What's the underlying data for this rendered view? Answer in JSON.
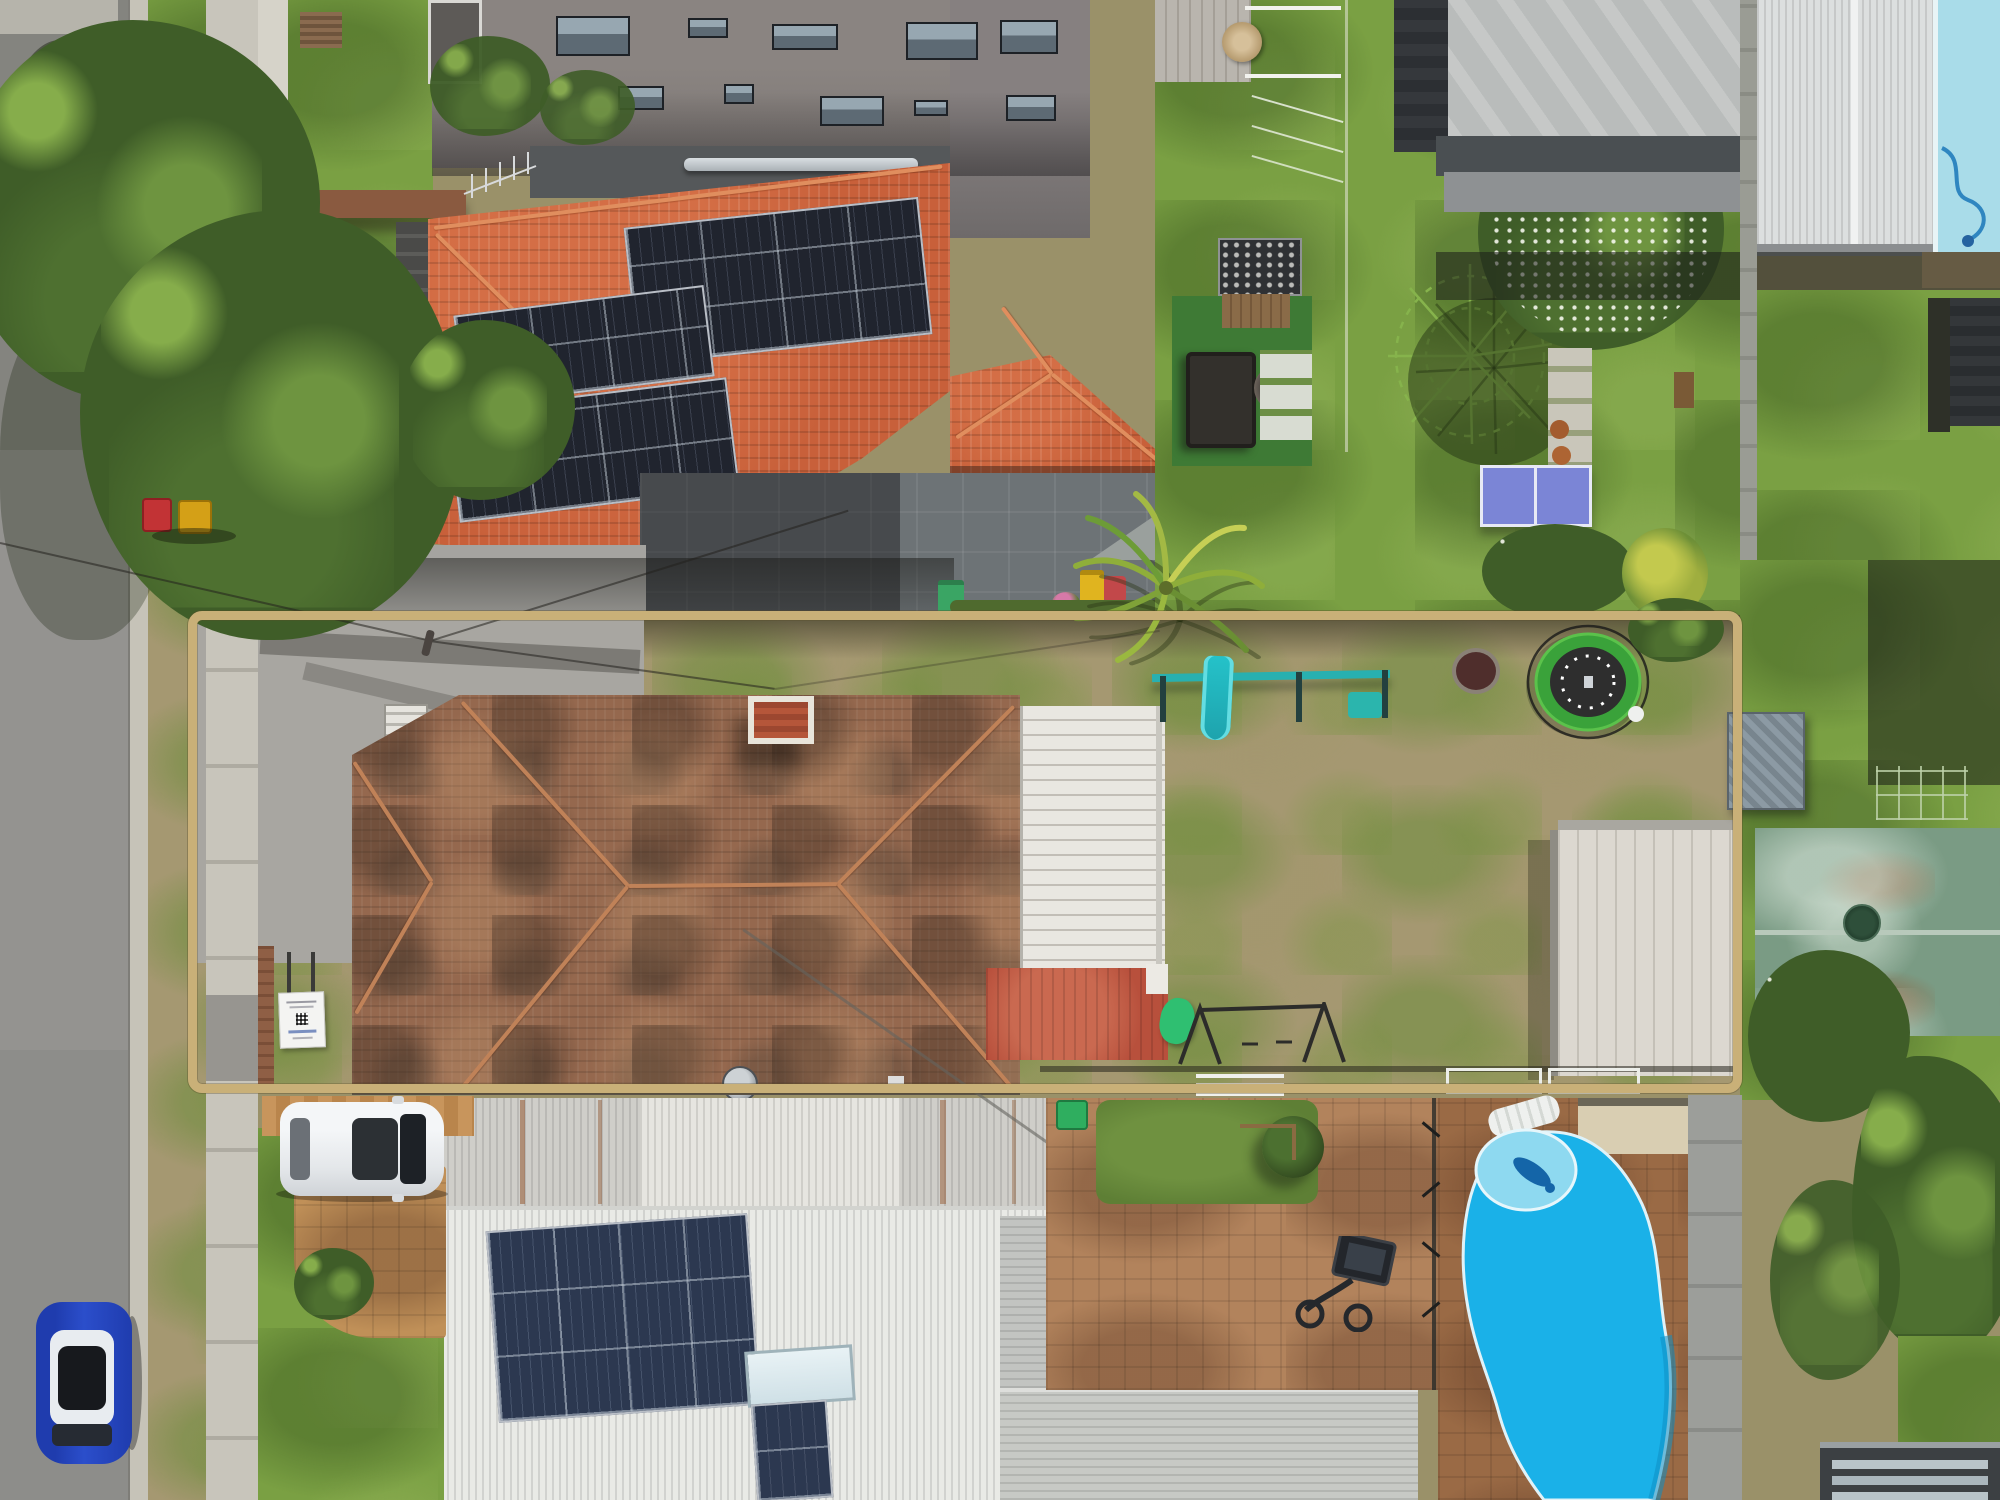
{
  "meta": {
    "domain": "Natural-Image",
    "image_type": "aerial drone photograph, top-down (nadir) view",
    "subject": "suburban residential block with a single property lot highlighted by a tan boundary outline overlay",
    "visible_text": "none legible (small white for-sale signboard with QR code is unreadable)"
  },
  "overlay": {
    "boundary_color": "#c9b078",
    "boundary_shape": "rounded rectangle outline around the middle property lot"
  },
  "palette": {
    "road_asphalt": "#8e8e8c",
    "concrete_path": "#c8c5bb",
    "bright_terracotta_roof": "#c8603a",
    "weathered_tile_roof": "#95684e",
    "solar_panel": "#20242e",
    "healthy_lawn": "#7aa043",
    "dry_patchy_lawn": "#a59871",
    "pool_water": "#1ab1e8",
    "pale_pool_water": "#a9dce9",
    "white_metal_roof": "#e9eae6",
    "green_metal_roof": "#7a9b84",
    "brick_paving": "#b2835c",
    "trampoline_pad": "#3aa23a",
    "play_gym_teal": "#28b0b0"
  },
  "scene": {
    "objects": [
      {
        "name": "road",
        "label": "asphalt street along left edge with concrete kerb, verge and footpath"
      },
      {
        "name": "street-trees",
        "label": "large green street trees casting shadows over road (top left)"
      },
      {
        "name": "apartment-building",
        "label": "grey multi-storey apartment building wall with windows (top centre)"
      },
      {
        "name": "orange-roof-house",
        "label": "two-storey house with bright terracotta tile hip roof and three black solar arrays"
      },
      {
        "name": "garage-orange-roof",
        "label": "detached garage with terracotta roof and four solar panels"
      },
      {
        "name": "courtyard",
        "label": "dark grey paved courtyard with green and yellow wheelie bins"
      },
      {
        "name": "ping-pong-table",
        "label": "blue table-tennis table on lawn"
      },
      {
        "name": "flowering-tree",
        "label": "large white-flowering tree on neighbouring lawn"
      },
      {
        "name": "rotary-clothesline",
        "label": "rotary hoist clothesline on lawn"
      },
      {
        "name": "highlighted-lot",
        "label": "subject property: weathered terracotta-roof house, white carport roof, patchy backyard"
      },
      {
        "name": "for-sale-sign",
        "label": "small white signboard with QR code in front yard"
      },
      {
        "name": "trampoline",
        "label": "round trampoline with green padding and enclosure net"
      },
      {
        "name": "play-gym",
        "label": "teal children's play gym with slide"
      },
      {
        "name": "swing-frame",
        "label": "black A-frame swing set"
      },
      {
        "name": "backyard-shed",
        "label": "large shed with white speckled roof (rear of lot)"
      },
      {
        "name": "palm-tree",
        "label": "palm tree overhanging the top boundary line"
      },
      {
        "name": "white-roof-house",
        "label": "neighbour below: white corrugated hip roof with solar array and skylight"
      },
      {
        "name": "swimming-pool",
        "label": "bright blue kidney-shaped in-ground pool with spa section and brick surround"
      },
      {
        "name": "pool-top-right",
        "label": "second pale-blue pool at top right corner"
      },
      {
        "name": "green-roof-house",
        "label": "weathered green corrugated roof house (right edge)"
      },
      {
        "name": "white-car",
        "label": "white SUV parked on brick driveway (bottom left)"
      },
      {
        "name": "blue-car",
        "label": "blue car with white roof parked on street (bottom left)"
      },
      {
        "name": "wheelie-bins",
        "label": "red and yellow bins on verge; green bins near fences"
      },
      {
        "name": "basketball-hoop",
        "label": "toppled basketball hoop unit on brick paving"
      },
      {
        "name": "power-lines",
        "label": "thin overhead service wires crossing the driveway"
      }
    ]
  }
}
